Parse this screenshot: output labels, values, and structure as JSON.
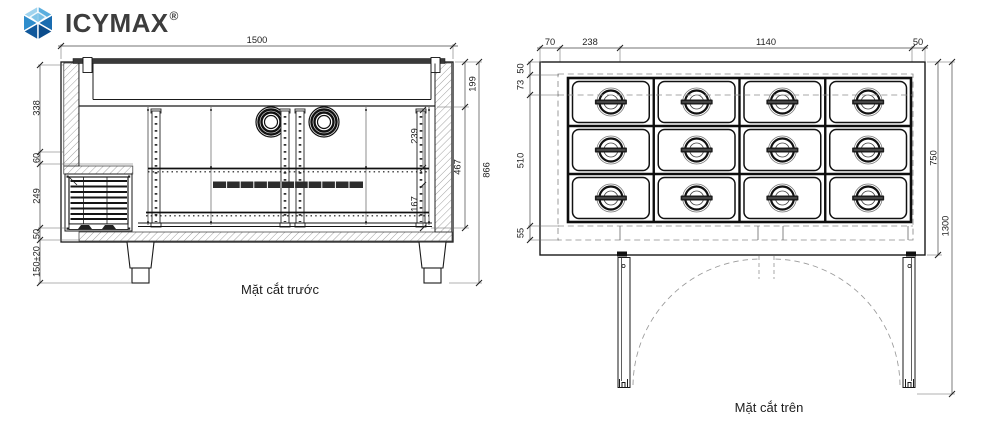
{
  "logo": {
    "icy": "ICY",
    "max": "MAX",
    "reg": "®",
    "icon": "faceted-hex-cube-icon",
    "colors": {
      "sky": "#9fd3ee",
      "light": "#5aaede",
      "mid": "#2f8dcc",
      "deep": "#1a6cb0",
      "navy": "#11599c",
      "dark": "#0c4d8c",
      "text": "#3d3d3d"
    }
  },
  "front_view": {
    "caption": "Mặt cắt trước",
    "dim_total_width": "1500",
    "dim_left": [
      "338",
      "60",
      "249",
      "50",
      "150±20"
    ],
    "dim_right_inner": [
      "239",
      "167"
    ],
    "dim_right_outer": [
      "199",
      "467",
      "866"
    ]
  },
  "top_view": {
    "caption": "Mặt cắt trên",
    "dim_top": [
      "70",
      "238",
      "1140",
      "50"
    ],
    "dim_left": [
      "50",
      "73",
      "510",
      "55"
    ],
    "dim_right": [
      "750",
      "1300"
    ],
    "pan_grid": {
      "rows": 3,
      "columns": 4
    }
  },
  "line_color": "#1a1a1a",
  "background": "#ffffff"
}
